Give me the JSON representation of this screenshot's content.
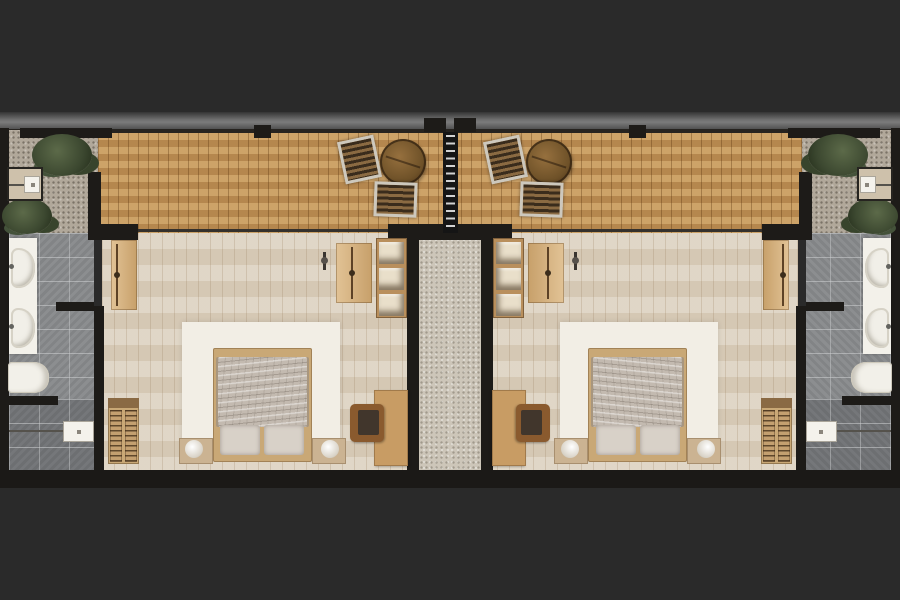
{
  "image": {
    "kind": "architectural-floor-plan",
    "view": "top-down",
    "subject": "Two mirrored studio suites separated by a central gravel walkway, each with a timber terrace deck (top), bedroom (center) and bathroom on the outer edge",
    "contains_text": false
  },
  "palette": {
    "bg": "#2a2a2a",
    "wall": "#1d1b18",
    "deck_wood": "#c2955a",
    "room_floor": "#dcd1bf",
    "gravel_courtyard": "#b1a89a",
    "gravel_corridor": "#cdc6b9",
    "tile_upper": "#8c8e90",
    "tile_lower": "#75777a",
    "white_fixture": "#f3f1ea",
    "rug": "#f2eee5",
    "tan_frame": "#c9a876",
    "tan_desk": "#c89c64",
    "duvet": "#c3bab0",
    "pillow": "#d8d1c8",
    "chair_frame": "#cdc8bd",
    "slat_dark": "#3a2c1c",
    "slat_light": "#8a6a42",
    "desk_chair": "#8a5a2e",
    "ladder": "#151515",
    "rung": "#d2d2d2"
  },
  "units": [
    {
      "name": "left-suite",
      "terrace": {
        "floor": "timber deck",
        "furniture": [
          "slatted lounge chair",
          "slatted lounge chair",
          "round wooden table"
        ]
      },
      "bedroom": {
        "floor": "light wood planks",
        "furniture": [
          "double bed with rumpled duvet and two pillows",
          "white area rug",
          "nightstand with round lamp (left)",
          "nightstand with round lamp (right)",
          "open wardrobe with hanging clothes",
          "open shelf unit",
          "desk",
          "desk chair",
          "floor lamp",
          "entry door panel",
          "side door panel"
        ]
      },
      "bathroom": {
        "floor": "grey tile",
        "fixtures": [
          "vanity counter",
          "basin sink",
          "basin sink",
          "toilet",
          "shower control box"
        ]
      },
      "courtyard": {
        "floor": "gravel",
        "features": [
          "plant",
          "plant",
          "equipment pad with control box"
        ]
      }
    },
    {
      "name": "right-suite",
      "mirror_of": "left-suite"
    }
  ],
  "corridor": {
    "name": "central-walkway",
    "floor": "light gravel",
    "divider": "black slatted privacy screen"
  }
}
